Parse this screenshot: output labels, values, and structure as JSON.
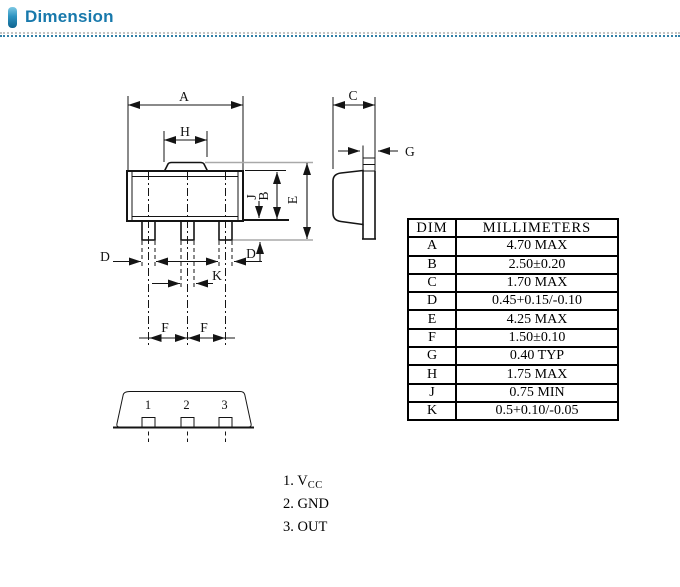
{
  "header": {
    "title": "Dimension"
  },
  "drawing": {
    "labels": {
      "a": "A",
      "h": "H",
      "j": "J",
      "b": "B",
      "e": "E",
      "d": "D",
      "k": "K",
      "f": "F",
      "c": "C",
      "g": "G"
    },
    "pins": [
      "1",
      "2",
      "3"
    ]
  },
  "table": {
    "headers": [
      "DIM",
      "MILLIMETERS"
    ],
    "rows": [
      [
        "A",
        "4.70 MAX"
      ],
      [
        "B",
        "2.50±0.20"
      ],
      [
        "C",
        "1.70 MAX"
      ],
      [
        "D",
        "0.45+0.15/-0.10"
      ],
      [
        "E",
        "4.25 MAX"
      ],
      [
        "F",
        "1.50±0.10"
      ],
      [
        "G",
        "0.40 TYP"
      ],
      [
        "H",
        "1.75 MAX"
      ],
      [
        "J",
        "0.75 MIN"
      ],
      [
        "K",
        "0.5+0.10/-0.05"
      ]
    ]
  },
  "pin_list": [
    {
      "text": "1. V",
      "sub": "CC"
    },
    {
      "text": "2. GND",
      "sub": ""
    },
    {
      "text": "3. OUT",
      "sub": ""
    }
  ]
}
